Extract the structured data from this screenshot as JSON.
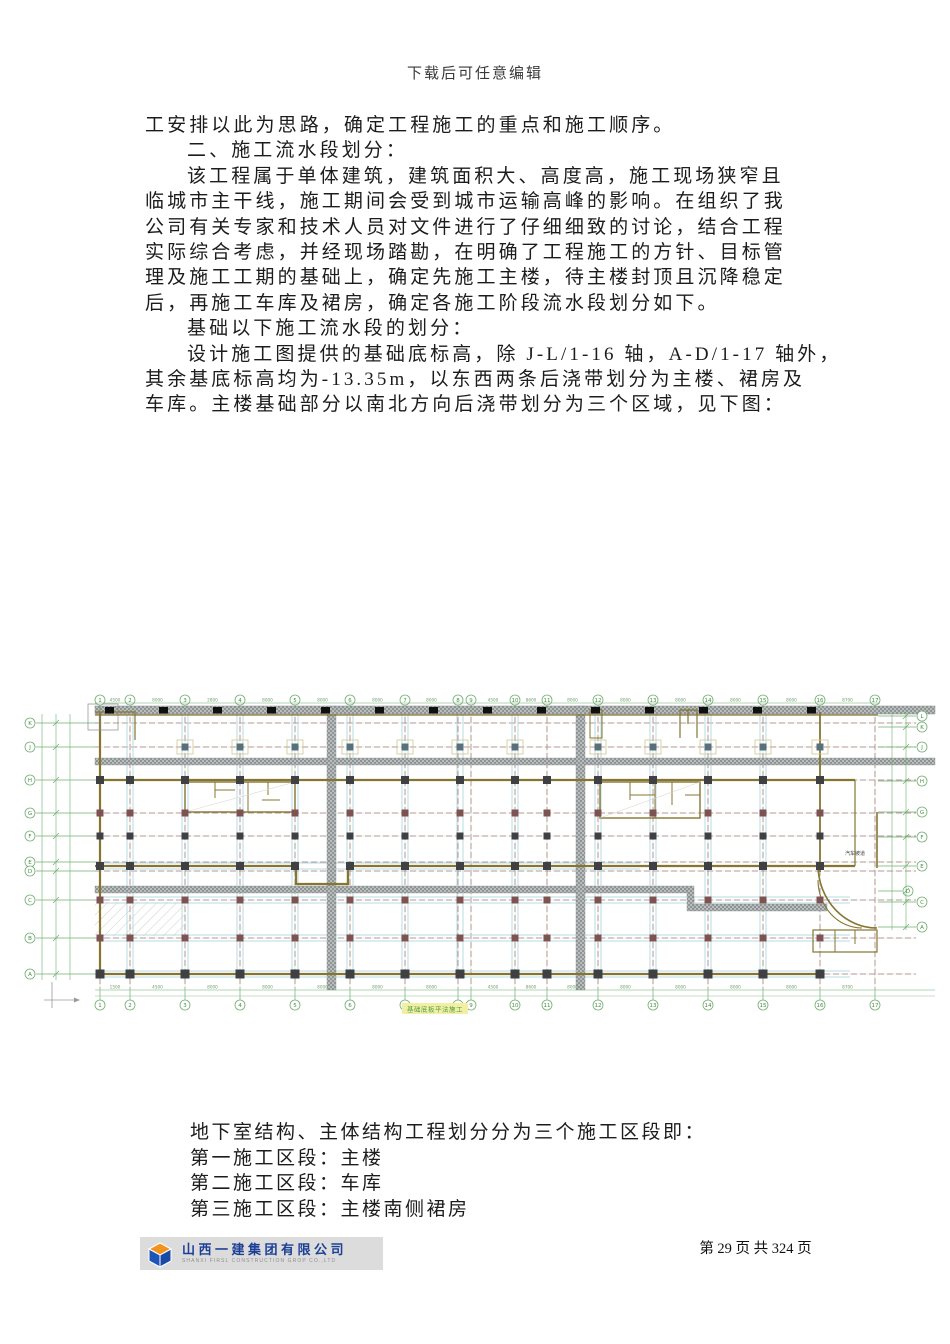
{
  "page": {
    "watermark": "下载后可任意编辑",
    "page_label": "第 29 页 共 324 页"
  },
  "body": {
    "lines": [
      {
        "text": "工安排以此为思路，确定工程施工的重点和施工顺序。",
        "indent": 0
      },
      {
        "text": "二、施工流水段划分：",
        "indent": 1
      },
      {
        "text": "该工程属于单体建筑，建筑面积大、高度高，施工现场狭窄且",
        "indent": 1
      },
      {
        "text": "临城市主干线，施工期间会受到城市运输高峰的影响。在组织了我",
        "indent": 0
      },
      {
        "text": "公司有关专家和技术人员对文件进行了仔细细致的讨论，结合工程",
        "indent": 0
      },
      {
        "text": "实际综合考虑，并经现场踏勘，在明确了工程施工的方针、目标管",
        "indent": 0
      },
      {
        "text": "理及施工工期的基础上，确定先施工主楼，待主楼封顶且沉降稳定",
        "indent": 0
      },
      {
        "text": "后，再施工车库及裙房，确定各施工阶段流水段划分如下。",
        "indent": 0
      },
      {
        "text": "基础以下施工流水段的划分：",
        "indent": 1
      },
      {
        "text": "设计施工图提供的基础底标高，除 J-L/1-16 轴，A-D/1-17 轴外，",
        "indent": 1
      },
      {
        "text": "其余基底标高均为-13.35m，以东西两条后浇带划分为主楼、裙房及",
        "indent": 0
      },
      {
        "text": "车库。主楼基础部分以南北方向后浇带划分为三个区域，见下图：",
        "indent": 0
      }
    ]
  },
  "section_list": {
    "lines": [
      "地下室结构、主体结构工程划分分为三个施工区段即：",
      "第一施工区段：主楼",
      "第二施工区段：车库",
      "第三施工区段：主楼南侧裙房"
    ]
  },
  "footer": {
    "company": "山西一建集团有限公司",
    "company_en": "SHANXI FIRSL CONSTRUCTION GROP CO.,LTD"
  },
  "plan": {
    "caption": "基础底板平法施工",
    "ramp_label": "汽车坡道",
    "cols": [
      {
        "label": "1",
        "x": 100
      },
      {
        "label": "2",
        "x": 130
      },
      {
        "label": "3",
        "x": 185
      },
      {
        "label": "4",
        "x": 240
      },
      {
        "label": "5",
        "x": 295
      },
      {
        "label": "6",
        "x": 350
      },
      {
        "label": "7",
        "x": 405
      },
      {
        "label": "8",
        "x": 458
      },
      {
        "label": "9",
        "x": 471
      },
      {
        "label": "10",
        "x": 515
      },
      {
        "label": "11",
        "x": 547
      },
      {
        "label": "12",
        "x": 598
      },
      {
        "label": "13",
        "x": 653
      },
      {
        "label": "14",
        "x": 708
      },
      {
        "label": "15",
        "x": 763
      },
      {
        "label": "16",
        "x": 820
      },
      {
        "label": "17",
        "x": 875
      }
    ],
    "left_rows": [
      {
        "label": "K",
        "y": 723
      },
      {
        "label": "J",
        "y": 747
      },
      {
        "label": "H",
        "y": 780
      },
      {
        "label": "G",
        "y": 813
      },
      {
        "label": "F",
        "y": 836
      },
      {
        "label": "E",
        "y": 862
      },
      {
        "label": "D",
        "y": 871
      },
      {
        "label": "C",
        "y": 900
      },
      {
        "label": "B",
        "y": 938
      },
      {
        "label": "A",
        "y": 974
      }
    ],
    "right_rows": [
      {
        "label": "L",
        "y": 716
      },
      {
        "label": "K",
        "y": 727
      },
      {
        "label": "J",
        "y": 747
      },
      {
        "label": "H",
        "y": 781
      },
      {
        "label": "G",
        "y": 812
      },
      {
        "label": "F",
        "y": 837
      },
      {
        "label": "E",
        "y": 866
      },
      {
        "label": "D",
        "y": 891
      },
      {
        "label": "C",
        "y": 902
      },
      {
        "label": "A",
        "y": 927
      }
    ],
    "top_dims": [
      "4500",
      "8000",
      "2800",
      "8000",
      "8000",
      "8000",
      "8000",
      "7700",
      "4500",
      "8600",
      "8000",
      "8000",
      "8000",
      "8000",
      "8000",
      "8700"
    ],
    "bottom_dims": [
      "1500",
      "4500",
      "8000",
      "8000",
      "8000",
      "8000",
      "8000",
      "8500",
      "4500",
      "8600",
      "8000",
      "8000",
      "8000",
      "8000",
      "8000",
      "8700"
    ],
    "colors": {
      "axis_green": "#6fae6f",
      "grid_green_pale": "#cfe3cf",
      "centerline_red": "#a87e7e",
      "cyan": "#badbe3",
      "olive": "#867531",
      "hatch_dark": "#8e9494",
      "hatch_light": "#b9bdbd",
      "column_dark": "#3f4043",
      "column_maroon": "#7c5252",
      "column_steel": "#57707a",
      "caption_green": "#4a9e4a",
      "caption_bg": "#f3efa2",
      "logo_blue": "#1e56b8",
      "logo_orange": "#f0931f",
      "company_blue": "#1d3f96"
    }
  }
}
